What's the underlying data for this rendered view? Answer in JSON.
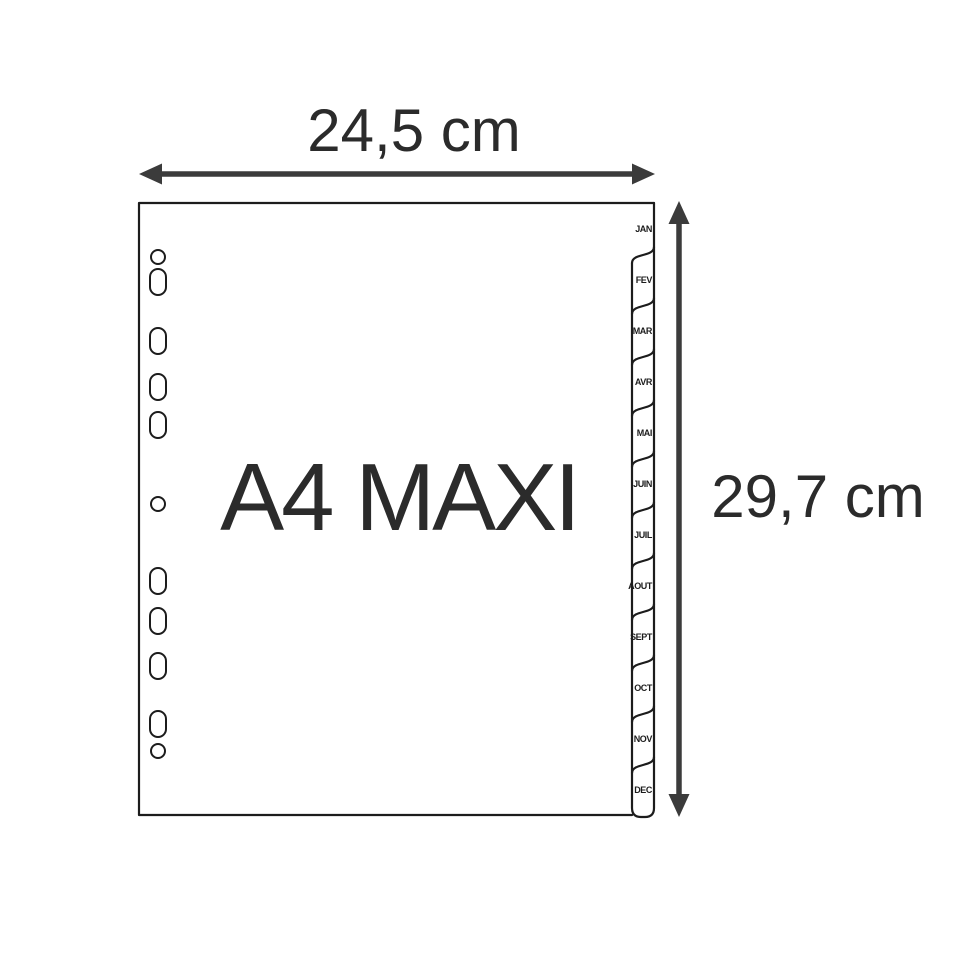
{
  "diagram": {
    "title": "A4 MAXI",
    "dimensions": {
      "width": "24,5 cm",
      "height": "29,7 cm"
    },
    "tabs": [
      "JAN",
      "FEV",
      "MAR",
      "AVR",
      "MAI",
      "JUIN",
      "JUIL",
      "AOUT",
      "SEPT",
      "OCT",
      "NOV",
      "DEC"
    ],
    "colors": {
      "background": "#ffffff",
      "sheet_outline": "#1c1c1c",
      "dimension_ink": "#3b3b3b",
      "text_ink": "#2b2b2b"
    }
  }
}
